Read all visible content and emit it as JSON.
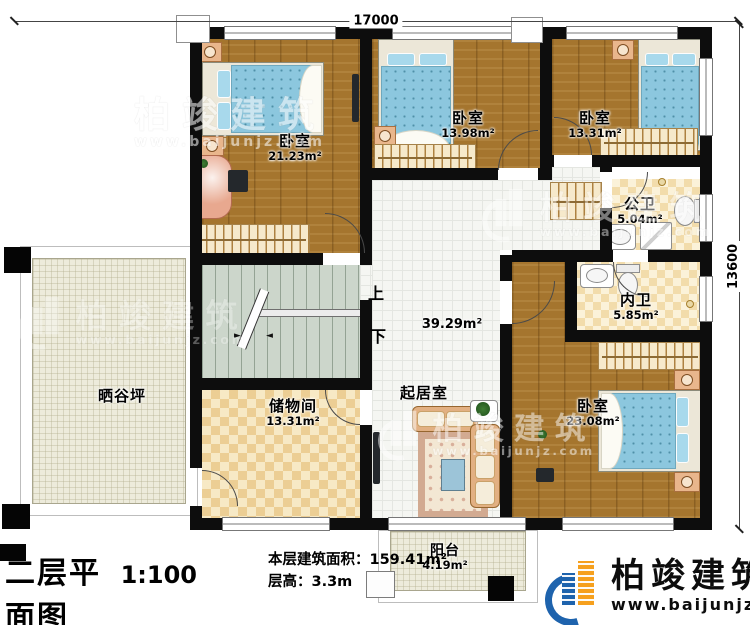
{
  "dimensions": {
    "top": "17000",
    "right": "13600"
  },
  "rooms": {
    "bed1": {
      "name": "卧室",
      "area": "21.23m²"
    },
    "bed2": {
      "name": "卧室",
      "area": "13.98m²"
    },
    "bed3": {
      "name": "卧室",
      "area": "13.31m²"
    },
    "gongwei": {
      "name": "公卫",
      "area": "5.04m²"
    },
    "neiwei": {
      "name": "内卫",
      "area": "5.85m²"
    },
    "bed4": {
      "name": "卧室",
      "area": "23.08m²"
    },
    "living": {
      "name": "起居室",
      "area": "39.29m²"
    },
    "storage": {
      "name": "储物间",
      "area": "13.31m²"
    },
    "terrace": {
      "name": "晒谷坪"
    },
    "balcony": {
      "name": "阳台",
      "area": "4.19m²"
    }
  },
  "stairs": {
    "up": "上",
    "down": "下"
  },
  "titleblock": {
    "title": "二层平面图",
    "scale": "1:100",
    "area_label": "本层建筑面积：",
    "area_value": "159.41m²",
    "floor_height_label": "层高：",
    "floor_height_value": "3.3m"
  },
  "brand": {
    "name": "柏竣建筑",
    "url": "www.baijunjz.com"
  },
  "watermark": {
    "name": "柏竣建筑",
    "url": "www.baijunjz.com"
  },
  "colors": {
    "wall": "#0d0d0d",
    "wood": "#a5752e",
    "brand_blue": "#1e63ad",
    "brand_orange": "#f6a01d"
  }
}
